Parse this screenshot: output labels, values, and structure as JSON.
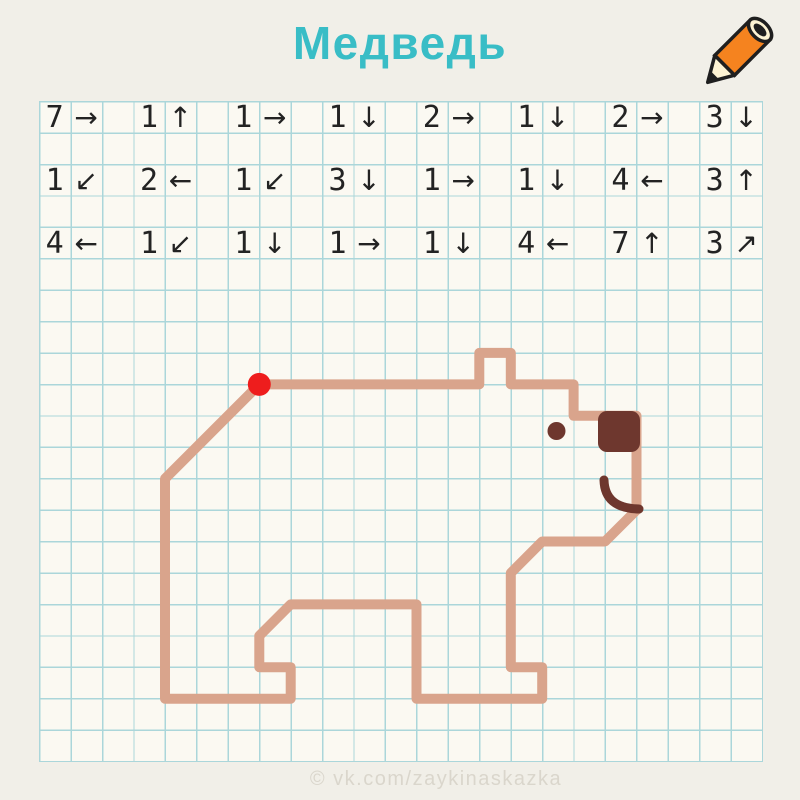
{
  "title": "Медведь",
  "watermark": "© vk.com/zaykinaskazka",
  "colors": {
    "page_bg": "#f1efe8",
    "paper": "#fbf9f2",
    "grid_line": "#abd6da",
    "accent_title": "#39bdc6",
    "ink": "#232323",
    "bear_line": "#d9a48c",
    "bear_dark": "#6e372e",
    "start_dot": "#ee1d1d",
    "watermark": "#dad6cc",
    "pencil_orange": "#f5831f",
    "pencil_cream": "#fdf3d3",
    "pencil_outline": "#1f1f1f"
  },
  "grid": {
    "cols": 23,
    "rows": 21
  },
  "instructions": {
    "rows": [
      {
        "items": [
          {
            "n": "7",
            "a": "→"
          },
          {
            "n": "1",
            "a": "↑"
          },
          {
            "n": "1",
            "a": "→"
          },
          {
            "n": "1",
            "a": "↓"
          },
          {
            "n": "2",
            "a": "→"
          },
          {
            "n": "1",
            "a": "↓"
          },
          {
            "n": "2",
            "a": "→"
          },
          {
            "n": "3",
            "a": "↓"
          }
        ]
      },
      {
        "items": [
          {
            "n": "1",
            "a": "↙"
          },
          {
            "n": "2",
            "a": "←"
          },
          {
            "n": "1",
            "a": "↙"
          },
          {
            "n": "3",
            "a": "↓"
          },
          {
            "n": "1",
            "a": "→"
          },
          {
            "n": "1",
            "a": "↓"
          },
          {
            "n": "4",
            "a": "←"
          },
          {
            "n": "3",
            "a": "↑"
          }
        ]
      },
      {
        "items": [
          {
            "n": "4",
            "a": "←"
          },
          {
            "n": "1",
            "a": "↙"
          },
          {
            "n": "1",
            "a": "↓"
          },
          {
            "n": "1",
            "a": "→"
          },
          {
            "n": "1",
            "a": "↓"
          },
          {
            "n": "4",
            "a": "←"
          },
          {
            "n": "7",
            "a": "↑"
          },
          {
            "n": "3",
            "a": "↗"
          }
        ]
      }
    ]
  },
  "drawing": {
    "figure": "bear",
    "stroke_width": 10,
    "path_cells": [
      [
        7,
        9
      ],
      [
        14,
        9
      ],
      [
        14,
        8
      ],
      [
        15,
        8
      ],
      [
        15,
        9
      ],
      [
        17,
        9
      ],
      [
        17,
        10
      ],
      [
        19,
        10
      ],
      [
        19,
        13
      ],
      [
        18,
        14
      ],
      [
        16,
        14
      ],
      [
        15,
        15
      ],
      [
        15,
        18
      ],
      [
        16,
        18
      ],
      [
        16,
        19
      ],
      [
        12,
        19
      ],
      [
        12,
        16
      ],
      [
        8,
        16
      ],
      [
        7,
        17
      ],
      [
        7,
        18
      ],
      [
        8,
        18
      ],
      [
        8,
        19
      ],
      [
        4,
        19
      ],
      [
        4,
        12
      ],
      [
        7,
        9
      ]
    ],
    "start_dot": {
      "cell": [
        7,
        9
      ],
      "radius": 11.5
    },
    "nose": {
      "x": 598,
      "y": 411,
      "w": 42,
      "h": 41,
      "rx": 9
    },
    "eye": {
      "cx": 556.5,
      "cy": 431,
      "r": 9
    },
    "mouth_path": "M 604 480 C 604.5 499 616 508.5 639 509",
    "mouth_width": 9
  }
}
